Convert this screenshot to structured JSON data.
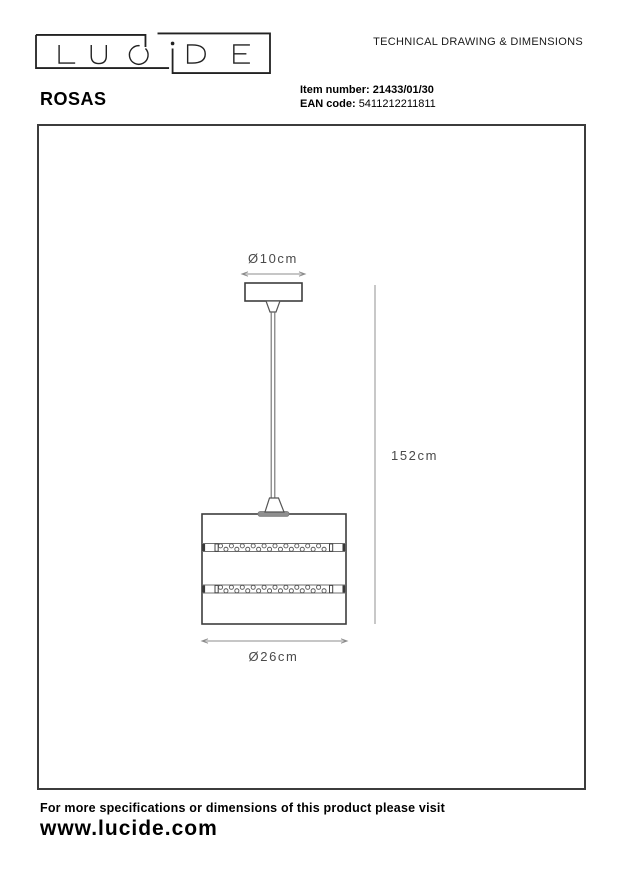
{
  "header": {
    "logo": {
      "word": "LUCIDE"
    },
    "doc_title": "TECHNICAL DRAWING & DIMENSIONS",
    "product_name": "ROSAS",
    "item_number_label": "Item number:",
    "item_number_value": "21433/01/30",
    "ean_label": "EAN code:",
    "ean_value": "5411212211811"
  },
  "drawing": {
    "dim_top_diameter": "Ø10cm",
    "dim_height": "152cm",
    "dim_bottom_diameter": "Ø26cm"
  },
  "footer": {
    "note": "For more specifications or dimensions of this product please visit",
    "website": "www.lucide.com"
  }
}
